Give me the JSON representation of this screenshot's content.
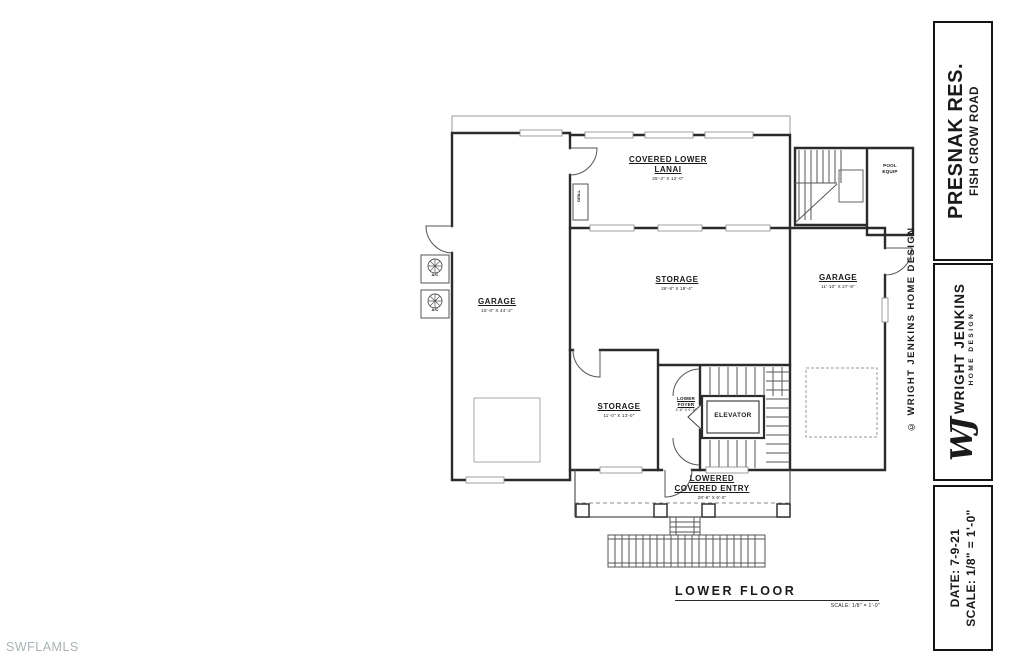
{
  "watermark": "SWFLAMLS",
  "plan": {
    "title": "LOWER FLOOR",
    "scale_note": "SCALE: 1/8\" = 1'-0\"",
    "labels": {
      "lanai": {
        "name": "COVERED LOWER LANAI",
        "dim": "25'-2\" X 12'-0\""
      },
      "garage_left": {
        "name": "GARAGE",
        "dim": "15'-0\" X 44'-2\""
      },
      "storage_main": {
        "name": "STORAGE",
        "dim": "28'-8\" X 18'-4\""
      },
      "garage_right": {
        "name": "GARAGE",
        "dim": "11'-10\" X 27'-8\""
      },
      "storage_lower": {
        "name": "STORAGE",
        "dim": "11'-0\" X 13'-0\""
      },
      "lower_foyer": {
        "name": "LOWER FOYER",
        "dim": "4'-6\" X 9'-0\""
      },
      "elevator": {
        "name": "ELEVATOR"
      },
      "entry": {
        "name": "LOWERED COVERED ENTRY",
        "dim": "28'-6\" X 6'-0\""
      },
      "pool_equip": {
        "name": "POOL EQUIP"
      },
      "grill": {
        "name": "GRILL"
      },
      "ac1": {
        "name": "A/C"
      },
      "ac2": {
        "name": "A/C"
      }
    }
  },
  "title_block": {
    "copyright": "© WRIGHT JENKINS HOME DESIGN",
    "project_name": "PRESNAK RES.",
    "project_address": "FISH CROW ROAD",
    "logo": "WJ",
    "firm_name": "WRIGHT JENKINS",
    "firm_tagline": "HOME DESIGN",
    "date": "DATE: 7-9-21",
    "scale": "SCALE: 1/8\" = 1'-0\""
  },
  "colors": {
    "wall_line": "#2b2b2b",
    "thin_line": "#777777",
    "text": "#1a1a1a",
    "watermark": "#a9b3b5",
    "background": "#ffffff"
  }
}
